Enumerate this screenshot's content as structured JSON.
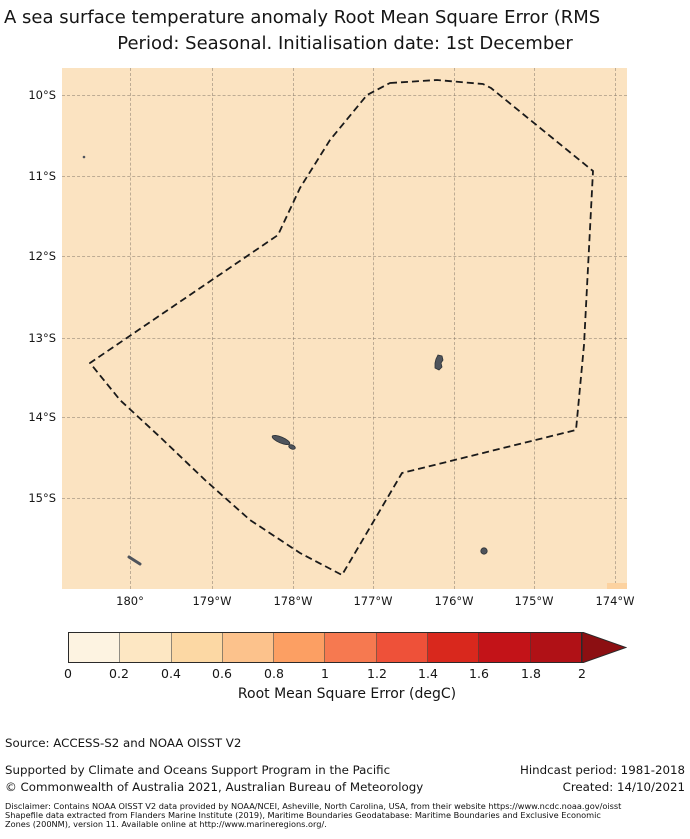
{
  "title": {
    "line1": "A sea surface temperature anomaly Root Mean Square Error (RMS",
    "line2": "Period: Seasonal. Initialisation date: 1st December"
  },
  "map": {
    "ocean_color": "#fbe3c1",
    "island_color": "#4f545c",
    "hot_cell_color": "#fcd2a0",
    "eez_points": "328,15 375,12 421,16 429,20 531,103 522,277 514,362 340,405 280,507 238,485 188,452 143,412 98,369 58,332 28,295 216,167 238,120 268,72 305,27",
    "x_ticks": [
      "180°",
      "179°W",
      "178°W",
      "177°W",
      "176°W",
      "175°W",
      "174°W"
    ],
    "y_ticks": [
      "10°S",
      "11°S",
      "12°S",
      "13°S",
      "14°S",
      "15°S"
    ]
  },
  "colorbar": {
    "label": "Root Mean Square Error (degC)",
    "ticks": [
      "0",
      "0.2",
      "0.4",
      "0.6",
      "0.8",
      "1",
      "1.2",
      "1.4",
      "1.6",
      "1.8",
      "2"
    ],
    "colors": [
      "#fdf3e1",
      "#fde7c3",
      "#fcd8a4",
      "#fcc28c",
      "#fc9f63",
      "#f67950",
      "#ee5139",
      "#d9281d",
      "#c31318",
      "#b01116"
    ],
    "arrow_color": "#8c0f12"
  },
  "footer": {
    "source": "Source: ACCESS-S2 and NOAA OISST V2",
    "supported": "Supported by Climate and Oceans Support Program in the Pacific",
    "copyright": "© Commonwealth of Australia 2021, Australian Bureau of Meteorology",
    "hindcast": "Hindcast period: 1981-2018",
    "created": "Created: 14/10/2021",
    "disclaimer_line1": "Disclaimer: Contains NOAA OISST V2 data provided by NOAA/NCEI, Asheville, North Carolina, USA, from their website https://www.ncdc.noaa.gov/oisst",
    "disclaimer_line2": "Shapefile data extracted from Flanders Marine Institute (2019), Maritime Boundaries Geodatabase: Maritime Boundaries and Exclusive Economic",
    "disclaimer_line3": "Zones (200NM), version 11. Available online at http://www.marineregions.org/."
  },
  "chart_data": {
    "type": "heatmap",
    "title": "A sea surface temperature anomaly Root Mean Square Error (RMS",
    "subtitle": "Period: Seasonal. Initialisation date: 1st December",
    "x_axis": {
      "ticks": [
        "180°",
        "179°W",
        "178°W",
        "177°W",
        "176°W",
        "175°W",
        "174°W"
      ],
      "range": "approx 180.9 to 173.9 degrees W"
    },
    "y_axis": {
      "ticks": [
        "10°S",
        "11°S",
        "12°S",
        "13°S",
        "14°S",
        "15°S"
      ],
      "range": "approx 9.7S to 16.1S"
    },
    "colorbar": {
      "label": "Root Mean Square Error (degC)",
      "ticks": [
        0,
        0.2,
        0.4,
        0.6,
        0.8,
        1,
        1.2,
        1.4,
        1.6,
        1.8,
        2
      ],
      "extend": "max",
      "bin_width": 0.2
    },
    "field": "RMSE nearly uniform over the whole domain, in the 0.2-0.4 degC colour bin; one grid cell near the SE corner (approx 174.2W, 15.9S) in the 0.4-0.6 degC bin",
    "overlays": [
      "dashed EEZ boundary polygon spanning approx 180.5W-174.2W and 9.9S-16.0S",
      "island markers near 176.2W 13.3S, 178.1W 14.3S, 175.6W 15.7S, 179.9W 15.8S, 180.5 10.8S"
    ]
  }
}
